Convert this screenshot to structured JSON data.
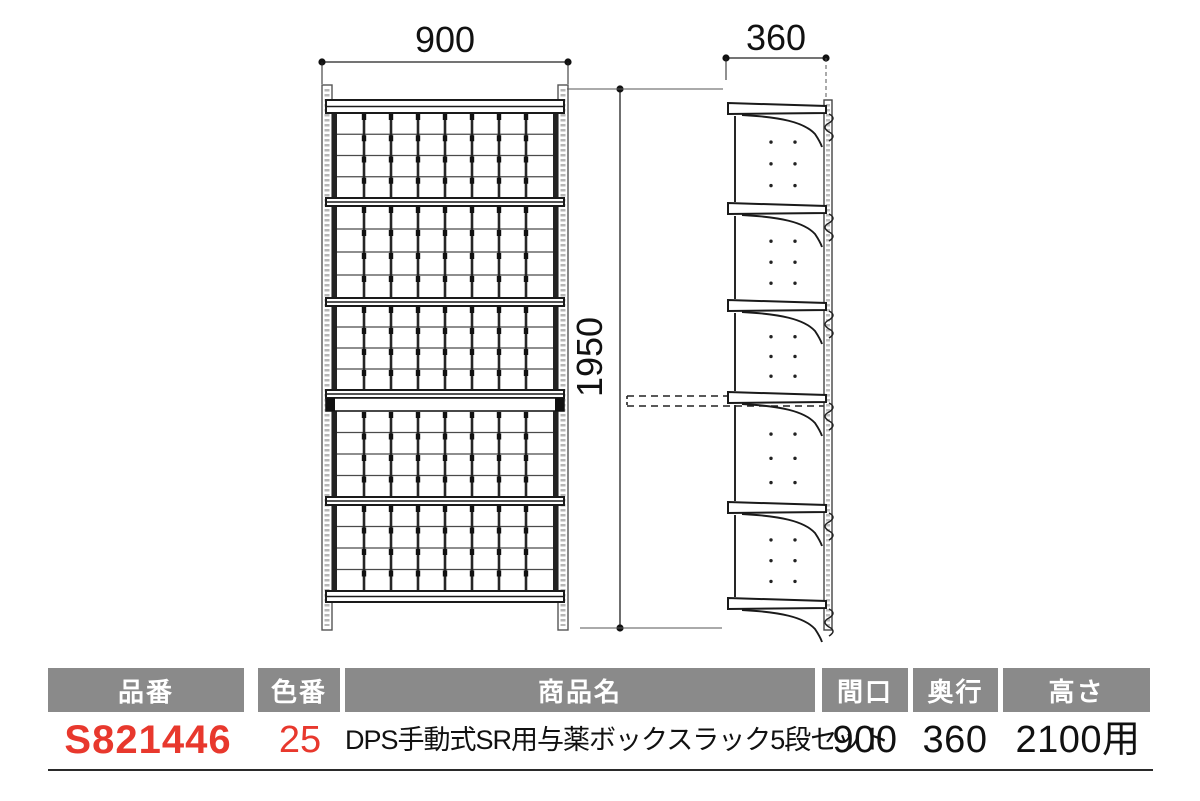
{
  "diagram": {
    "front_width_label": "900",
    "side_depth_label": "360",
    "height_label": "1950",
    "front_view": {
      "sections": 5,
      "columns": 8,
      "rows": 4
    },
    "side_view": {
      "tiers": 5
    }
  },
  "table": {
    "headers": [
      "品番",
      "色番",
      "商品名",
      "間口",
      "奥行",
      "高さ"
    ],
    "row": {
      "part_number": "S821446",
      "color_number": "25",
      "product_name": "DPS手動式SR用与薬ボックスラック5段セット",
      "width": "900",
      "depth": "360",
      "height": "2100用"
    }
  },
  "colors": {
    "header_bg": "#8a8a8a",
    "header_text": "#ffffff",
    "accent_red": "#e8382d",
    "line": "#1a1a1a"
  }
}
